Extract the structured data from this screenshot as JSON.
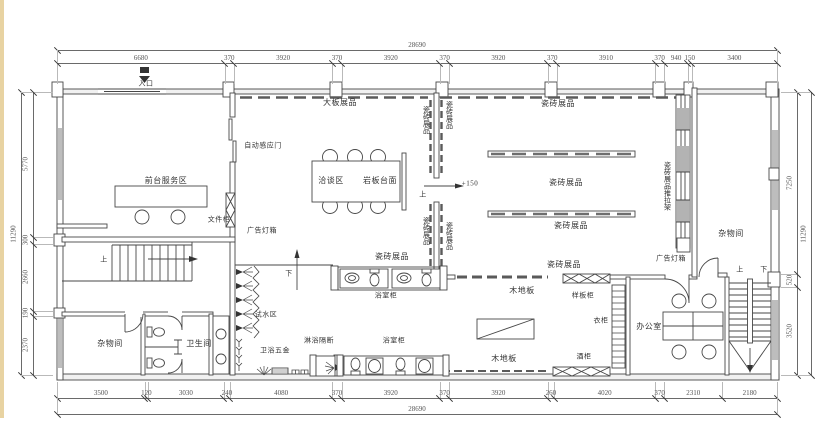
{
  "colors": {
    "paper": "#ffffff",
    "line": "#474747",
    "dim_text": "#555555",
    "label_text": "#333333",
    "wall_poche": "#bdbdbd",
    "left_strip": "#e8d3a2"
  },
  "dimensions": {
    "top": {
      "total": "28690",
      "segments": [
        "6680",
        "370",
        "3920",
        "370",
        "3920",
        "370",
        "3920",
        "370",
        "3910",
        "370",
        "940",
        "150",
        "3400"
      ]
    },
    "bottom": {
      "total": "28690",
      "segments": [
        "3500",
        "120",
        "3030",
        "240",
        "4080",
        "370",
        "3920",
        "370",
        "3920",
        "260",
        "4020",
        "370",
        "2310",
        "2180"
      ]
    },
    "left": {
      "total": "11290",
      "segments": [
        "5770",
        "300",
        "2660",
        "190",
        "2370"
      ]
    },
    "right": {
      "total": "11290",
      "segments": [
        "7250",
        "520",
        "3520"
      ]
    }
  },
  "labels": [
    {
      "text": "入口",
      "x": 146,
      "y": 84,
      "size": 7
    },
    {
      "text": "前台服务区",
      "x": 166,
      "y": 181
    },
    {
      "text": "自动感应门",
      "x": 263,
      "y": 146,
      "size": 7
    },
    {
      "text": "文件柜",
      "x": 219,
      "y": 220,
      "size": 7
    },
    {
      "text": "广告灯箱",
      "x": 262,
      "y": 231,
      "size": 7
    },
    {
      "text": "大板展品",
      "x": 340,
      "y": 103
    },
    {
      "text": "洽谈区",
      "x": 331,
      "y": 181
    },
    {
      "text": "岩板台面",
      "x": 380,
      "y": 181
    },
    {
      "text": "瓷砖展品",
      "x": 426,
      "y": 120,
      "v": true,
      "size": 7
    },
    {
      "text": "瓷砖展品",
      "x": 449,
      "y": 115,
      "v": true,
      "size": 7
    },
    {
      "text": "瓷砖展品",
      "x": 426,
      "y": 231,
      "v": true,
      "size": 7
    },
    {
      "text": "瓷砖展品",
      "x": 449,
      "y": 236,
      "v": true,
      "size": 7
    },
    {
      "text": "上",
      "x": 423,
      "y": 195,
      "size": 7
    },
    {
      "text": "+150",
      "x": 470,
      "y": 184,
      "size": 7
    },
    {
      "text": "瓷砖展品",
      "x": 558,
      "y": 104
    },
    {
      "text": "瓷砖展品",
      "x": 566,
      "y": 183
    },
    {
      "text": "瓷砖展品",
      "x": 571,
      "y": 226
    },
    {
      "text": "瓷砖展品",
      "x": 392,
      "y": 257
    },
    {
      "text": "瓷砖展品",
      "x": 564,
      "y": 265
    },
    {
      "text": "瓷砖展品推拉架",
      "x": 667,
      "y": 186,
      "v": true,
      "size": 7
    },
    {
      "text": "广告灯箱",
      "x": 671,
      "y": 259,
      "size": 7
    },
    {
      "text": "杂物间",
      "x": 731,
      "y": 234
    },
    {
      "text": "上",
      "x": 740,
      "y": 270,
      "size": 7
    },
    {
      "text": "下",
      "x": 764,
      "y": 270,
      "size": 7
    },
    {
      "text": "办公室",
      "x": 649,
      "y": 327
    },
    {
      "text": "衣柜",
      "x": 601,
      "y": 321,
      "size": 7
    },
    {
      "text": "样板柜",
      "x": 583,
      "y": 296,
      "size": 7
    },
    {
      "text": "木地板",
      "x": 522,
      "y": 291
    },
    {
      "text": "木地板",
      "x": 504,
      "y": 359
    },
    {
      "text": "酒柜",
      "x": 584,
      "y": 357,
      "size": 7
    },
    {
      "text": "浴室柜",
      "x": 386,
      "y": 296,
      "size": 7
    },
    {
      "text": "浴室柜",
      "x": 394,
      "y": 341,
      "size": 7
    },
    {
      "text": "淋浴隔断",
      "x": 319,
      "y": 341,
      "size": 7
    },
    {
      "text": "卫浴五金",
      "x": 275,
      "y": 351,
      "size": 7
    },
    {
      "text": "试水区",
      "x": 266,
      "y": 315,
      "size": 7
    },
    {
      "text": "下",
      "x": 289,
      "y": 274,
      "size": 7
    },
    {
      "text": "卫生间",
      "x": 199,
      "y": 344
    },
    {
      "text": "杂物间",
      "x": 110,
      "y": 344
    },
    {
      "text": "上",
      "x": 104,
      "y": 260,
      "size": 7
    }
  ]
}
